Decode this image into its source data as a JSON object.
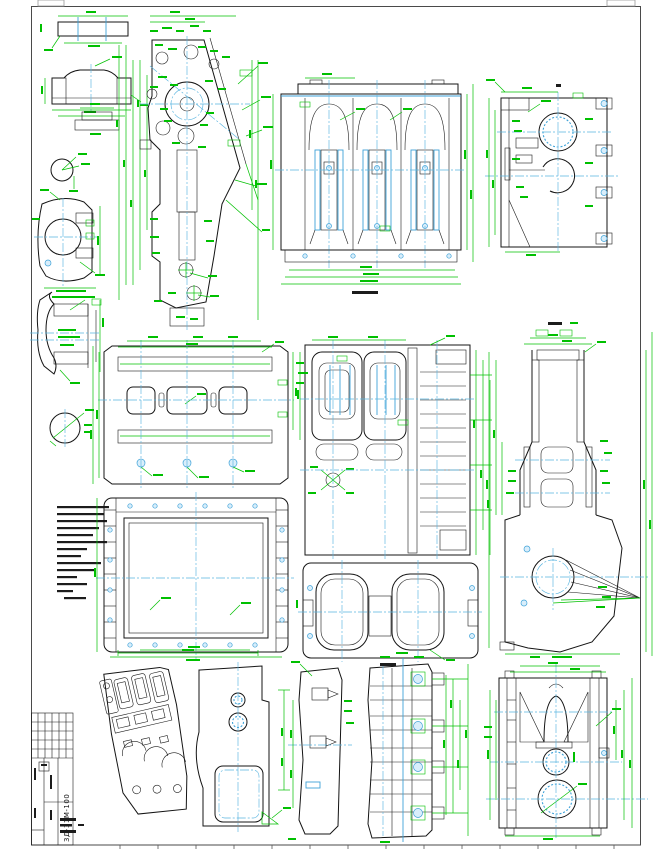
{
  "sheet": {
    "background": "#ffffff",
    "border_color": "#4a4a4a"
  },
  "colors": {
    "dimension_green": "#00c000",
    "centerline_blue": "#5ab5e0",
    "liner_blue": "#3ea2d8",
    "outline_black": "#141414",
    "hatch": "#2a2a2a"
  },
  "title_block": {
    "drawing_number": "3Д-31М-100"
  }
}
